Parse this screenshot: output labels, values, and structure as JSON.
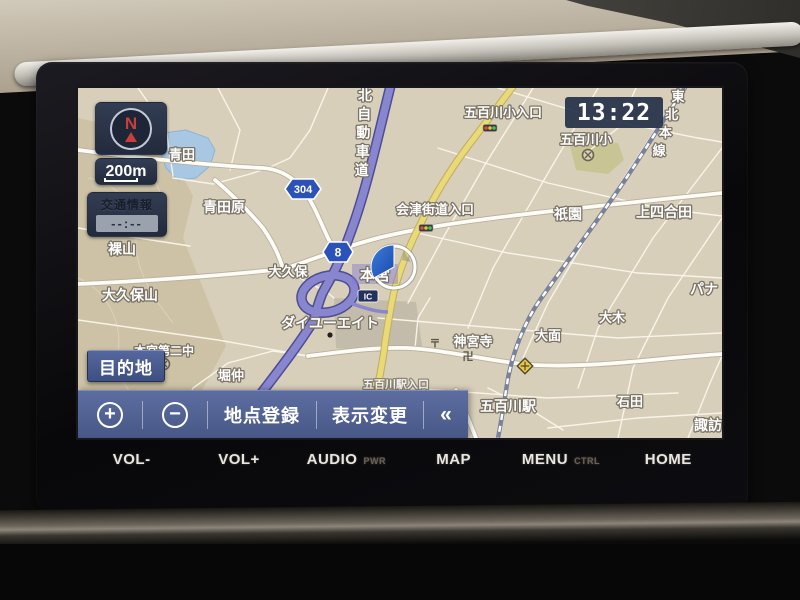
{
  "device": {
    "hardware_buttons": [
      {
        "label": "VOL-",
        "sub": ""
      },
      {
        "label": "VOL+",
        "sub": ""
      },
      {
        "label": "AUDIO",
        "sub": "PWR"
      },
      {
        "label": "MAP",
        "sub": ""
      },
      {
        "label": "MENU",
        "sub": "CTRL"
      },
      {
        "label": "HOME",
        "sub": ""
      }
    ]
  },
  "screen": {
    "clock": "13:22",
    "compass": {
      "north": "N"
    },
    "scale_label": "200m",
    "traffic_info": {
      "title": "交通情報",
      "time": "--:--"
    },
    "destination_button": "目的地",
    "toolbar": {
      "zoom_in": "+",
      "zoom_out": "−",
      "register_point": "地点登録",
      "display_change": "表示変更",
      "collapse": "«"
    },
    "map": {
      "expressway_name": "北自動車道",
      "railway_name": "東北本線",
      "interchange_name": "本宮",
      "ic_label": "IC",
      "route_shields": [
        {
          "number": "304"
        },
        {
          "number": "8"
        }
      ],
      "labels": [
        {
          "text": "青田",
          "x": 104,
          "y": 71,
          "size": 13
        },
        {
          "text": "青田原",
          "x": 146,
          "y": 124,
          "size": 14
        },
        {
          "text": "裸山",
          "x": 44,
          "y": 166,
          "size": 14
        },
        {
          "text": "大久保山",
          "x": 52,
          "y": 212,
          "size": 14
        },
        {
          "text": "大久保",
          "x": 210,
          "y": 188,
          "size": 13
        },
        {
          "text": "堀仲",
          "x": 153,
          "y": 292,
          "size": 13
        },
        {
          "text": "本宮第二中",
          "x": 86,
          "y": 267,
          "size": 12
        },
        {
          "text": "ダイユーエイト",
          "x": 252,
          "y": 240,
          "size": 14
        },
        {
          "text": "会津街道入口",
          "x": 357,
          "y": 126,
          "size": 13
        },
        {
          "text": "五百川小入口",
          "x": 425,
          "y": 29,
          "size": 13
        },
        {
          "text": "五百川小",
          "x": 508,
          "y": 56,
          "size": 13
        },
        {
          "text": "祇園",
          "x": 490,
          "y": 131,
          "size": 14
        },
        {
          "text": "上四合田",
          "x": 586,
          "y": 129,
          "size": 14
        },
        {
          "text": "パナ",
          "x": 626,
          "y": 206,
          "size": 14
        },
        {
          "text": "大木",
          "x": 534,
          "y": 234,
          "size": 13
        },
        {
          "text": "大面",
          "x": 470,
          "y": 252,
          "size": 13
        },
        {
          "text": "神宮寺",
          "x": 395,
          "y": 258,
          "size": 13
        },
        {
          "text": "〒",
          "x": 357,
          "y": 259,
          "size": 11,
          "dark": true
        },
        {
          "text": "卍",
          "x": 390,
          "y": 272,
          "size": 11,
          "dark": true
        },
        {
          "text": "五百川駅",
          "x": 430,
          "y": 323,
          "size": 14
        },
        {
          "text": "石田",
          "x": 552,
          "y": 318,
          "size": 13
        },
        {
          "text": "諏訪",
          "x": 630,
          "y": 342,
          "size": 14
        },
        {
          "text": "五百川駅入口",
          "x": 318,
          "y": 300,
          "size": 11,
          "opacity": 0.8
        }
      ]
    }
  }
}
